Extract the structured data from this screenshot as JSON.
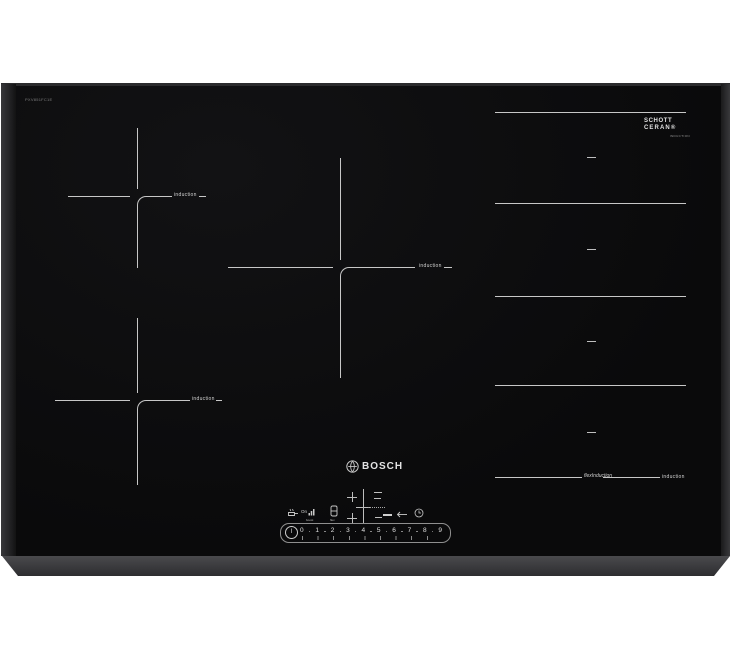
{
  "hob": {
    "brand": "BOSCH",
    "model_label": "PXV851FC1E",
    "glass_logo": {
      "line1": "SCHOTT",
      "line2": "CERAN®",
      "sub": "INDUCTION"
    },
    "zones": {
      "top_left_label": "induction",
      "middle_label": "induction",
      "bottom_left_label": "induction",
      "flex_label": "induction",
      "flex_logo": "flexInduction"
    }
  },
  "controls": {
    "pan_on": "On",
    "boost": "boost",
    "flex": "flex",
    "power": "I",
    "levels": [
      "0",
      "1",
      "2",
      "3",
      "4",
      "5",
      "6",
      "7",
      "8",
      "9"
    ]
  },
  "colors": {
    "background": "#ffffff",
    "glass": "#0b0b0c",
    "frame": "#3b3b3d",
    "marking": "#c7c7c7"
  }
}
